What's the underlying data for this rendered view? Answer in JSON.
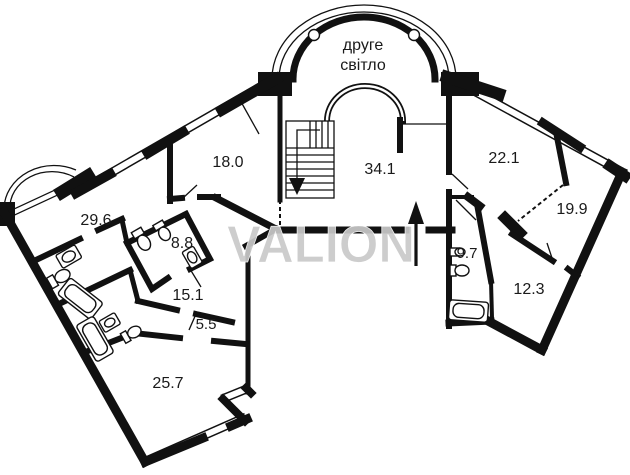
{
  "watermark": "VALION",
  "second_light": {
    "line1": "друге",
    "line2": "світло"
  },
  "rooms": [
    {
      "name": "room-29-6",
      "area": "29.6"
    },
    {
      "name": "room-18-0",
      "area": "18.0"
    },
    {
      "name": "room-8-8",
      "area": "8.8"
    },
    {
      "name": "room-15-1",
      "area": "15.1"
    },
    {
      "name": "room-5-5",
      "area": "5.5"
    },
    {
      "name": "room-25-7",
      "area": "25.7"
    },
    {
      "name": "room-34-1",
      "area": "34.1"
    },
    {
      "name": "room-22-1",
      "area": "22.1"
    },
    {
      "name": "room-19-9",
      "area": "19.9"
    },
    {
      "name": "room-12-3",
      "area": "12.3"
    },
    {
      "name": "room-9-7",
      "area": "9.7"
    }
  ],
  "colors": {
    "walls": "#111111",
    "watermark": "#c9c9c9",
    "background": "#ffffff"
  }
}
